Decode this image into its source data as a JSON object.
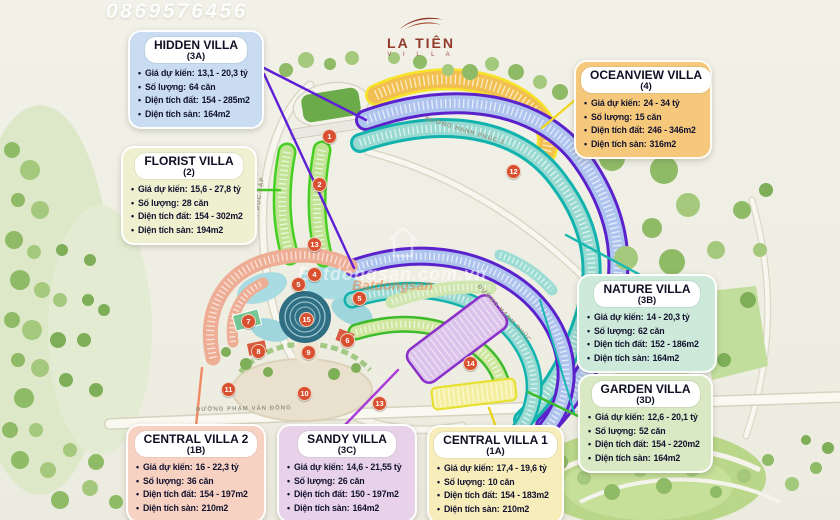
{
  "watermarks": {
    "phone": "0869576456",
    "brand_white": "Batdongsan.com.vn",
    "brand_orange": "Batdongsan"
  },
  "logo": {
    "name": "LA TIÊN",
    "tagline": "V I L L A"
  },
  "labels": {
    "price": "Giá dự kiến:",
    "quantity": "Số lượng:",
    "land_area": "Diện tích đất:",
    "floor_area": "Diện tích sàn:"
  },
  "villas": [
    {
      "name": "HIDDEN VILLA",
      "code": "(3A)",
      "price": "13,1 - 20,3 tỷ",
      "quantity": "64 căn",
      "land_area": "154 - 285m2",
      "floor_area": "164m2",
      "bg": "#c9dcf2",
      "accent": "#5f1fd6"
    },
    {
      "name": "FLORIST VILLA",
      "code": "(2)",
      "price": "15,6 - 27,8 tỷ",
      "quantity": "28 căn",
      "land_area": "154 - 302m2",
      "floor_area": "194m2",
      "bg": "#eef0d0",
      "accent": "#3fcb1e"
    },
    {
      "name": "OCEANVIEW VILLA",
      "code": "(4)",
      "price": "24 - 34 tỷ",
      "quantity": "15 căn",
      "land_area": "246 - 346m2",
      "floor_area": "316m2",
      "bg": "#f6c87b",
      "accent": "#f0d820"
    },
    {
      "name": "NATURE VILLA",
      "code": "(3B)",
      "price": "14 - 20,3 tỷ",
      "quantity": "62 căn",
      "land_area": "152 - 186m2",
      "floor_area": "164m2",
      "bg": "#cde9da",
      "accent": "#17b8b2"
    },
    {
      "name": "GARDEN VILLA",
      "code": "(3D)",
      "price": "12,6 - 20,1 tỷ",
      "quantity": "52 căn",
      "land_area": "154 - 220m2",
      "floor_area": "164m2",
      "bg": "#d8e9c4",
      "accent": "#3dbb2a"
    },
    {
      "name": "CENTRAL VILLA 2",
      "code": "(1B)",
      "price": "16 - 22,3 tỷ",
      "quantity": "36 căn",
      "land_area": "154 - 197m2",
      "floor_area": "210m2",
      "bg": "#f7d2c3",
      "accent": "#ef8a64"
    },
    {
      "name": "SANDY VILLA",
      "code": "(3C)",
      "price": "14,6 - 21,55 tỷ",
      "quantity": "26 căn",
      "land_area": "150 - 197m2",
      "floor_area": "164m2",
      "bg": "#e7d2ea",
      "accent": "#a93bd6"
    },
    {
      "name": "CENTRAL VILLA 1",
      "code": "(1A)",
      "price": "17,4 - 19,6 tỷ",
      "quantity": "10 căn",
      "land_area": "154 - 183m2",
      "floor_area": "210m2",
      "bg": "#f7edba",
      "accent": "#e6d51c"
    }
  ],
  "map": {
    "roads": [
      "ĐƯỜNG ĐỘC LẬP",
      "ĐƯỜNG HẠNH PHÚC 2",
      "ĐƯỜNG HẠNH PHÚC",
      "ĐƯỜNG PHẠM VĂN ĐỒNG",
      "ĐƯỜNG PHẠM VĂN ĐỒNG"
    ],
    "markers": [
      {
        "n": "1",
        "x": 328,
        "y": 135
      },
      {
        "n": "2",
        "x": 318,
        "y": 183
      },
      {
        "n": "13",
        "x": 313,
        "y": 243
      },
      {
        "n": "4",
        "x": 313,
        "y": 273
      },
      {
        "n": "5",
        "x": 297,
        "y": 283
      },
      {
        "n": "5",
        "x": 358,
        "y": 297
      },
      {
        "n": "7",
        "x": 247,
        "y": 320
      },
      {
        "n": "15",
        "x": 305,
        "y": 318
      },
      {
        "n": "8",
        "x": 257,
        "y": 350
      },
      {
        "n": "9",
        "x": 307,
        "y": 351
      },
      {
        "n": "6",
        "x": 346,
        "y": 339
      },
      {
        "n": "11",
        "x": 227,
        "y": 388
      },
      {
        "n": "10",
        "x": 303,
        "y": 392
      },
      {
        "n": "13",
        "x": 378,
        "y": 402
      },
      {
        "n": "14",
        "x": 469,
        "y": 362
      },
      {
        "n": "12",
        "x": 512,
        "y": 170
      }
    ]
  }
}
